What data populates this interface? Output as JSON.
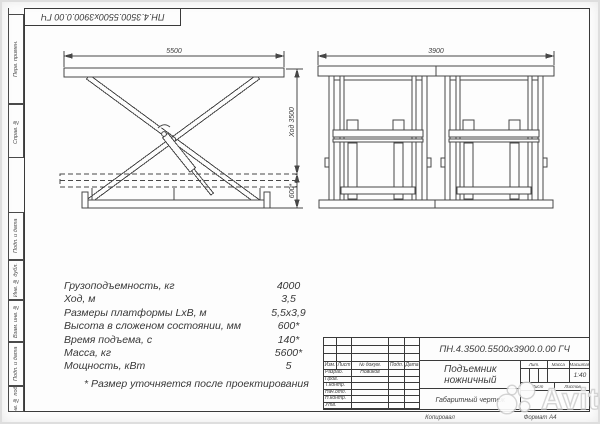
{
  "sheet": {
    "top_designation": "ПН.4.3500.5500х3900.0.00 ГЧ",
    "margin_labels": [
      "Перв. примен.",
      "Справ. №",
      "Подп. и дата",
      "Инв. № дубл.",
      "Взам. инв. №",
      "Подп. и дата",
      "Инв. № подл."
    ],
    "copied_label": "Копировал",
    "format_label": "Формат А4"
  },
  "views": {
    "side": {
      "dim_width": "5500",
      "dim_stroke": "Ход 3500",
      "dim_closed": "600*"
    },
    "front": {
      "dim_width": "3900"
    }
  },
  "specs": {
    "rows": [
      {
        "label": "Грузоподъемность, кг",
        "value": "4000"
      },
      {
        "label": "Ход, м",
        "value": "3,5"
      },
      {
        "label": "Размеры платформы LхВ, м",
        "value": "5,5х3,9"
      },
      {
        "label": "Высота в сложеном состоянии, мм",
        "value": "600*"
      },
      {
        "label": "Время подъема, с",
        "value": "140*"
      },
      {
        "label": "Масса, кг",
        "value": "5600*"
      },
      {
        "label": "Мощность, кВт",
        "value": "5"
      }
    ],
    "footnote": "* Размер уточняется после проектирования"
  },
  "titleblock": {
    "designation": "ПН.4.3500.5500х3900.0.00 ГЧ",
    "product_name": "Подъемник ножничный",
    "doc_type": "Габаритный чертеж",
    "header": {
      "izm": "Изм.",
      "list": "Лист",
      "doc": "№ докум.",
      "sign": "Подп.",
      "date": "Дата"
    },
    "rows": [
      {
        "label": "Разраб.",
        "name": "Новиков"
      },
      {
        "label": "Пров.",
        "name": ""
      },
      {
        "label": "Т.контр.",
        "name": ""
      },
      {
        "label": "Нач.отд.",
        "name": ""
      },
      {
        "label": "Н.контр.",
        "name": ""
      },
      {
        "label": "Утв.",
        "name": ""
      }
    ],
    "lit_label": "Лит.",
    "mass_label": "Масса",
    "scale_label": "Масштаб",
    "scale_value": "1:40",
    "sheet_label": "Лист",
    "sheets_label": "Листов"
  },
  "watermark": {
    "text": "Avito"
  }
}
